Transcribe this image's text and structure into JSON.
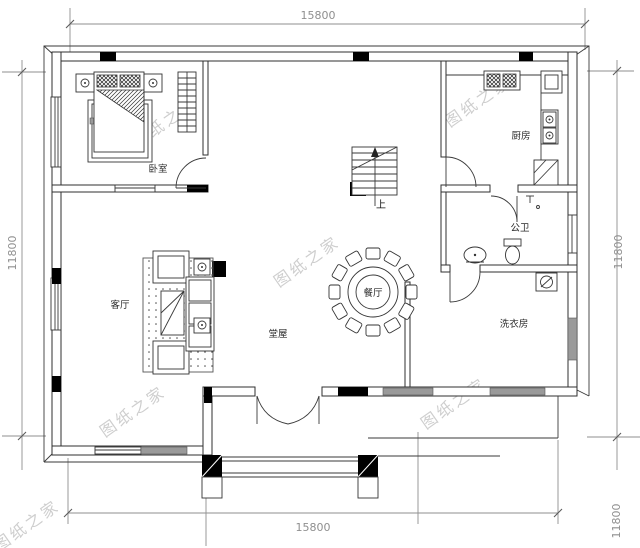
{
  "drawing": {
    "watermark": "图纸之家",
    "dimensions": {
      "top": "15800",
      "bottom": "15800",
      "left": "11800",
      "right": "11800",
      "right_lower": "11800"
    },
    "rooms": {
      "bedroom": "卧室",
      "living_room": "客厅",
      "main_hall": "堂屋",
      "dining": "餐厅",
      "kitchen": "厨房",
      "bathroom": "公卫",
      "laundry": "洗衣房"
    },
    "stairs_up": "上"
  }
}
